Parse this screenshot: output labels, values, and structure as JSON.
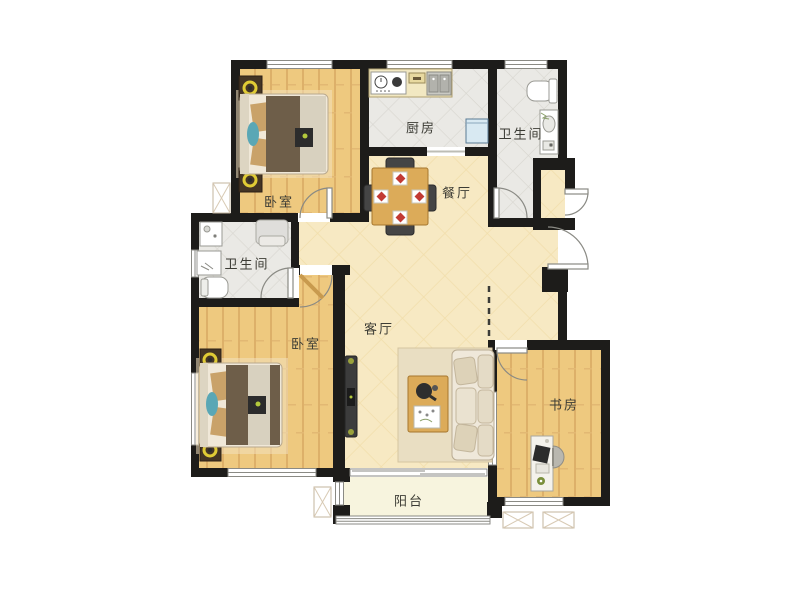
{
  "plan": {
    "type": "apartment-floor-plan",
    "colors": {
      "wall": "#1d1c1a",
      "wood_floor": "#eec97f",
      "hall_floor": "#f7e9c3",
      "tile_floor": "#eae9e5",
      "balcony_floor": "#f7f4de",
      "door_line": "#8a8a84",
      "lamp_accent": "#e0cb35",
      "table_wood": "#dcab59",
      "fridge": "#d8e9f2"
    },
    "rooms": {
      "bedroom_top": {
        "label": "卧室"
      },
      "kitchen": {
        "label": "厨房"
      },
      "bathroom_top": {
        "label": "卫生间"
      },
      "dining": {
        "label": "餐厅"
      },
      "bathroom_left": {
        "label": "卫生间"
      },
      "bedroom_bottom": {
        "label": "卧室"
      },
      "living": {
        "label": "客厅"
      },
      "study": {
        "label": "书房"
      },
      "balcony": {
        "label": "阳台"
      }
    }
  }
}
